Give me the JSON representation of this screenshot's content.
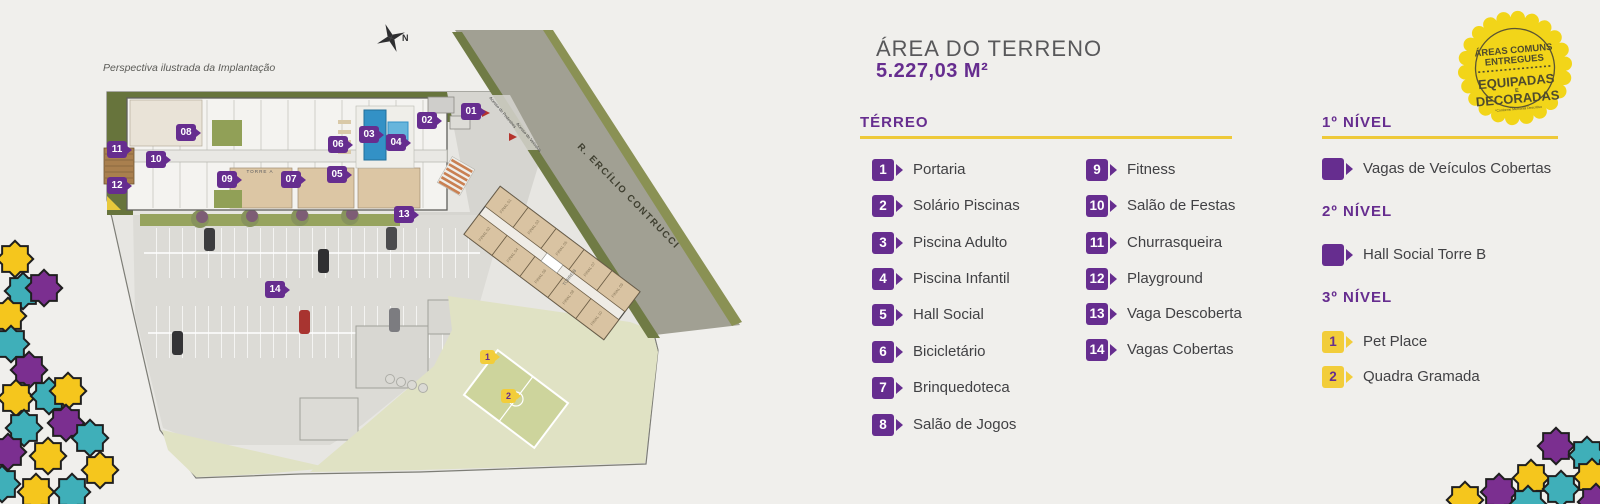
{
  "palette": {
    "purple": "#662d8f",
    "gold": "#f2cd3a",
    "goldline": "#eec939",
    "star_yellow": "#f5c61d",
    "star_teal": "#3fafb9",
    "star_purple": "#7b2f90",
    "badge_yellow": "#f2d519"
  },
  "plan": {
    "caption": "Perspectiva ilustrada da Implantação",
    "compass_label": "N",
    "street_label": "R. ERCÍLIO CONTRUCCI",
    "torre_a_label": "TORRE A",
    "torre_b_label": "TORRE B",
    "torre_b_units": [
      "FINAL 01",
      "FINAL 02",
      "FINAL 03",
      "FINAL 04",
      "FINAL 05",
      "FINAL 06",
      "FINAL 07",
      "FINAL 08",
      "FINAL 09",
      "FINAL 10"
    ],
    "access_labels": [
      "Acesso de Pedestres",
      "Acesso de Veículos"
    ],
    "markers": [
      {
        "label": "01"
      },
      {
        "label": "02"
      },
      {
        "label": "03"
      },
      {
        "label": "04"
      },
      {
        "label": "05"
      },
      {
        "label": "06"
      },
      {
        "label": "07"
      },
      {
        "label": "08"
      },
      {
        "label": "09"
      },
      {
        "label": "10"
      },
      {
        "label": "11"
      },
      {
        "label": "12"
      },
      {
        "label": "13"
      },
      {
        "label": "14"
      }
    ],
    "yellow_markers": [
      {
        "label": "1"
      },
      {
        "label": "2"
      }
    ]
  },
  "panel": {
    "title": "ÁREA DO TERRENO",
    "area_value": "5.227,03 M²",
    "terreo": {
      "heading": "TÉRREO",
      "items": [
        {
          "num": "1",
          "label": "Portaria"
        },
        {
          "num": "2",
          "label": "Solário Piscinas"
        },
        {
          "num": "3",
          "label": "Piscina Adulto"
        },
        {
          "num": "4",
          "label": "Piscina Infantil"
        },
        {
          "num": "5",
          "label": "Hall Social"
        },
        {
          "num": "6",
          "label": "Bicicletário"
        },
        {
          "num": "7",
          "label": "Brinquedoteca"
        },
        {
          "num": "8",
          "label": "Salão de Jogos"
        },
        {
          "num": "9",
          "label": "Fitness"
        },
        {
          "num": "10",
          "label": "Salão de Festas"
        },
        {
          "num": "11",
          "label": "Churrasqueira"
        },
        {
          "num": "12",
          "label": "Playground"
        },
        {
          "num": "13",
          "label": "Vaga Descoberta"
        },
        {
          "num": "14",
          "label": "Vagas Cobertas"
        }
      ]
    },
    "levels": [
      {
        "heading": "1º NÍVEL",
        "items": [
          {
            "num": "",
            "label": "Vagas de Veículos Cobertas"
          }
        ]
      },
      {
        "heading": "2º NÍVEL",
        "items": [
          {
            "num": "",
            "label": "Hall Social Torre B"
          }
        ]
      },
      {
        "heading": "3º NÍVEL",
        "items": [
          {
            "num": "1",
            "label": "Pet Place"
          },
          {
            "num": "2",
            "label": "Quadra Gramada"
          }
        ]
      }
    ]
  },
  "badge": {
    "line1": "ÁREAS COMUNS",
    "line2": "ENTREGUES",
    "line3": "EQUIPADAS",
    "line4": "E",
    "line5": "DECORADAS",
    "disclaimer": "*Conforme Memorial Descritivo"
  }
}
